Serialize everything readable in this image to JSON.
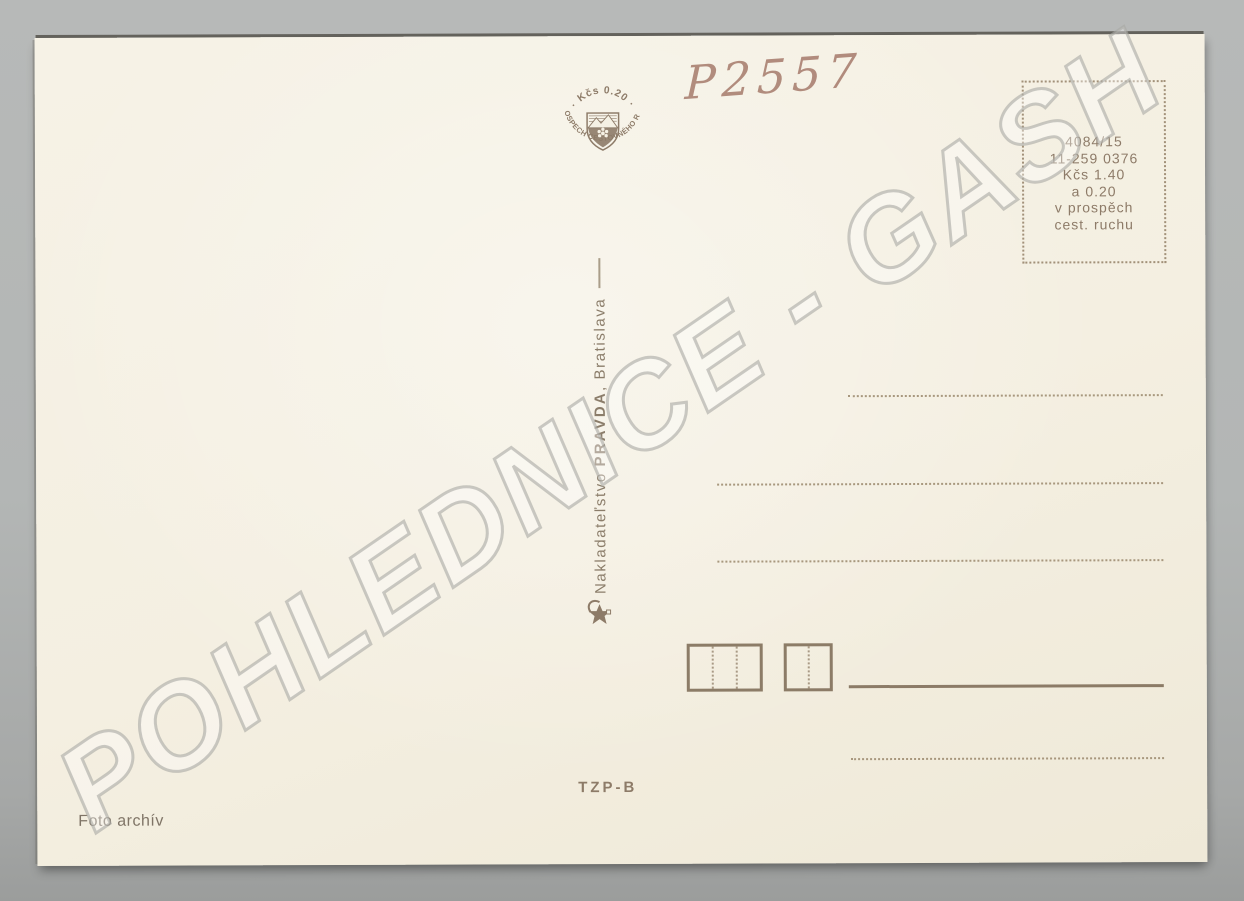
{
  "photo": {
    "watermark_text": "POHLEDNICE - GASH",
    "handwritten_code": "P2557"
  },
  "postcard": {
    "emblem": {
      "top_arc": "· Kčs 0.20 ·",
      "bottom_arc": "V PROSPECH CESTOVNÉHO RUCHU"
    },
    "stamp_box_lines": {
      "l1": "4084/15",
      "l2": "11-259 0376",
      "l3": "Kčs 1.40",
      "l4": "a 0.20",
      "l5": "v prospěch",
      "l6": "cest. ruchu"
    },
    "publisher": {
      "prefix": "Nakladateľstvo ",
      "name": "PRAVDA",
      "suffix": ", Bratislava"
    },
    "series_code": "TZP-B",
    "photo_credit": "Foto archív",
    "colors": {
      "ink": "#8d7b68",
      "paper": "#f5f1e4",
      "photo_background": "#b4b6b5"
    }
  }
}
